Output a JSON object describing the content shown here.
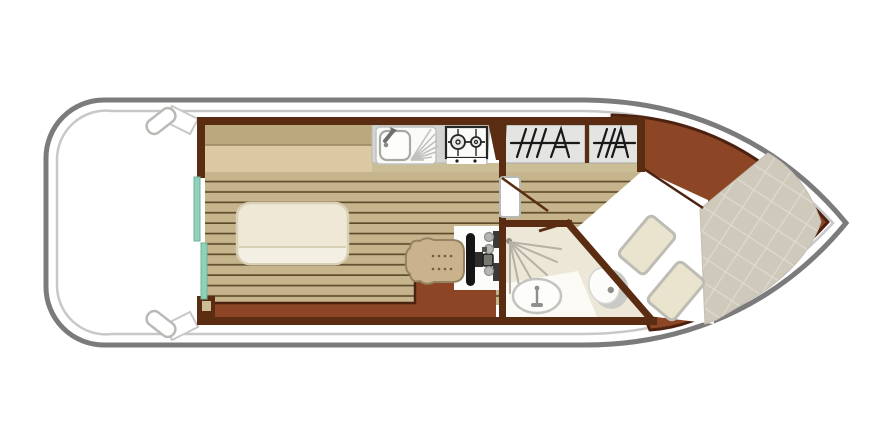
{
  "canvas": {
    "width": 890,
    "height": 446
  },
  "plan": {
    "view": "top-down-deck-plan",
    "areas": [
      {
        "name": "aft-deck"
      },
      {
        "name": "saloon"
      },
      {
        "name": "galley"
      },
      {
        "name": "helm-station"
      },
      {
        "name": "wardrobe-corridor"
      },
      {
        "name": "bathroom"
      },
      {
        "name": "bow-cabin"
      }
    ],
    "fixtures": [
      {
        "name": "cleat",
        "count": 2
      },
      {
        "name": "sliding-door-panel",
        "count": 2
      },
      {
        "name": "bench-seat"
      },
      {
        "name": "dinette-table"
      },
      {
        "name": "sink"
      },
      {
        "name": "gas-hob",
        "burners": 2
      },
      {
        "name": "helm-seat"
      },
      {
        "name": "steering-wheel"
      },
      {
        "name": "instrument-panel"
      },
      {
        "name": "wardrobe",
        "count": 2
      },
      {
        "name": "cabin-door",
        "count": 2
      },
      {
        "name": "shower"
      },
      {
        "name": "washbasin"
      },
      {
        "name": "toilet"
      },
      {
        "name": "double-bed"
      },
      {
        "name": "pillow",
        "count": 2
      }
    ]
  },
  "colors": {
    "hull_stroke": "#7b7b7b",
    "gunwale": "#c8c8c8",
    "wall": "#5a2c12",
    "walkway": "#8c4626",
    "walkway_border": "#4c2110",
    "plank": "#c6b58c",
    "plank_line": "#5f4c2c",
    "bench_back": "#bca87e",
    "bench_seat": "#dbc9a3",
    "shelf": "#cbbd96",
    "table_fill": "#efe8d6",
    "table_stroke": "#d9d0b8",
    "table_leaf": "#f4efe3",
    "teal": "#8fd2bb",
    "teal_stroke": "#6db39a",
    "counter": "#d4d4d1",
    "unit_white": "#fafaf8",
    "steel": "#a8a8a4",
    "dark_line": "#262624",
    "wardrobe": "#e4e4e2",
    "hanger": "#191919",
    "bath_floor": "#ece7d7",
    "bath_floor_light": "#fbfaf5",
    "spray": "#b5b2a5",
    "spray_dot": "#8d8d84",
    "fixture_stroke": "#c3c3bf",
    "fixture_gray": "#c9c9c5",
    "fixture_dot": "#90908a",
    "quilt": "#cfc9bc",
    "quilt_line": "#dfdacf",
    "pillow": "#eae3cd",
    "pillow_stroke": "#bdbdb5",
    "seat": "#c9b28c",
    "seat_stroke": "#958360",
    "seat_dot": "#6f5e41",
    "wheel": "#151515",
    "hub": "#77776f",
    "instr_dark": "#3a3a38",
    "instr_gray": "#b5b5b1",
    "white": "#ffffff"
  }
}
